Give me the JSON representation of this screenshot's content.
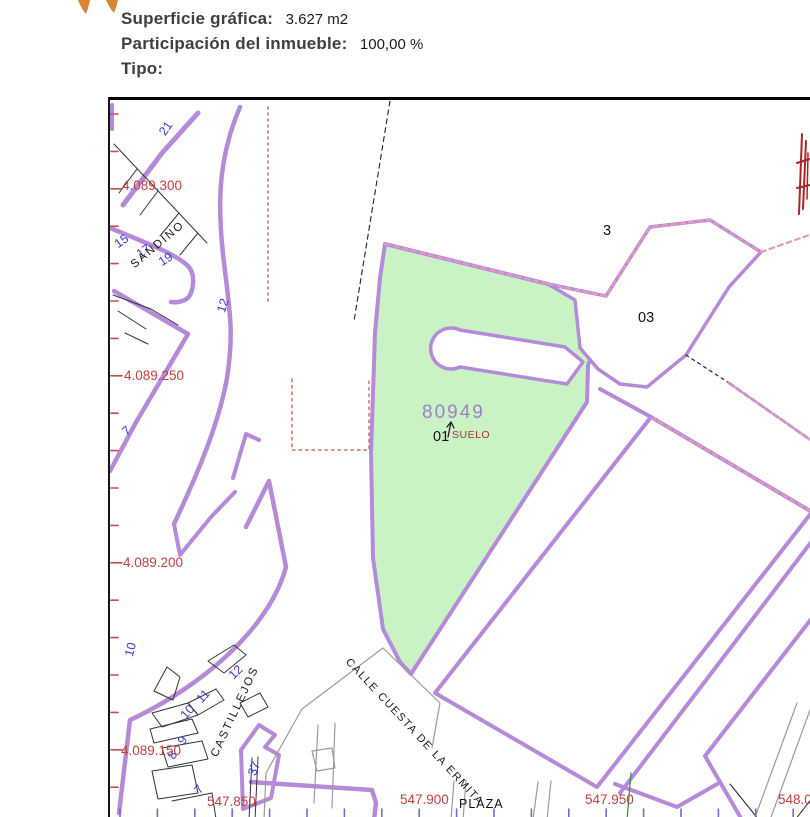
{
  "header": {
    "superficie_label": "Superficie gráfica:",
    "superficie_value": "3.627 m2",
    "participacion_label": "Participación del inmueble:",
    "participacion_value": "100,00 %",
    "tipo_label": "Tipo:",
    "tipo_value": ""
  },
  "map": {
    "parcel_id": "80949",
    "colors": {
      "boundary_purple": "#b58ad9",
      "parcel_fill_green": "#c9f3c5",
      "coordinate_red": "#c04040",
      "house_number_blue": "#3a3acc",
      "parcel_id_purple": "#9d7fd0",
      "dashed_pink": "#e49ac0"
    },
    "labels": [
      {
        "name": "house-number-21",
        "text": "21",
        "x": 160,
        "y": 125,
        "rot": -55,
        "cls": "blue"
      },
      {
        "name": "coord-y-4089300",
        "text": "4.089.300",
        "x": 120,
        "y": 176,
        "rot": 0,
        "cls": "red"
      },
      {
        "name": "house-number-15",
        "text": "15",
        "x": 114,
        "y": 236,
        "rot": -35,
        "cls": "blue"
      },
      {
        "name": "house-number-17",
        "text": "17",
        "x": 136,
        "y": 246,
        "rot": -35,
        "cls": "blue"
      },
      {
        "name": "house-number-19",
        "text": "19",
        "x": 158,
        "y": 254,
        "rot": -33,
        "cls": "blue"
      },
      {
        "name": "street-sandino",
        "text": "SANDINO",
        "x": 131,
        "y": 258,
        "rot": -40,
        "cls": "street"
      },
      {
        "name": "house-number-12-upper",
        "text": "12",
        "x": 219,
        "y": 303,
        "rot": -72,
        "cls": "blue"
      },
      {
        "name": "coord-y-4089250",
        "text": "4.089.250",
        "x": 122,
        "y": 366,
        "rot": 0,
        "cls": "red"
      },
      {
        "name": "house-number-7-left",
        "text": "7",
        "x": 122,
        "y": 424,
        "rot": -40,
        "cls": "blue"
      },
      {
        "name": "coord-y-4089200",
        "text": "4.089.200",
        "x": 121,
        "y": 553,
        "rot": 0,
        "cls": "red"
      },
      {
        "name": "house-number-10-left",
        "text": "10",
        "x": 127,
        "y": 647,
        "rot": -75,
        "cls": "blue"
      },
      {
        "name": "house-number-12-lower",
        "text": "12",
        "x": 229,
        "y": 668,
        "rot": -45,
        "cls": "blue"
      },
      {
        "name": "house-number-11",
        "text": "11",
        "x": 197,
        "y": 692,
        "rot": -48,
        "cls": "blue"
      },
      {
        "name": "house-number-10-lower",
        "text": "10",
        "x": 181,
        "y": 708,
        "rot": -48,
        "cls": "blue"
      },
      {
        "name": "house-number-9",
        "text": "9",
        "x": 179,
        "y": 734,
        "rot": -60,
        "cls": "blue"
      },
      {
        "name": "house-number-8",
        "text": "8",
        "x": 169,
        "y": 749,
        "rot": -60,
        "cls": "blue"
      },
      {
        "name": "street-castillejos",
        "text": "CASTILLEJOS",
        "x": 213,
        "y": 748,
        "rot": -65,
        "cls": "street"
      },
      {
        "name": "coord-y-4089150",
        "text": "4.089.150",
        "x": 119,
        "y": 741,
        "rot": 0,
        "cls": "red"
      },
      {
        "name": "house-number-37",
        "text": "37",
        "x": 250,
        "y": 766,
        "rot": -70,
        "cls": "blue"
      },
      {
        "name": "house-number-7-lower",
        "text": "7",
        "x": 195,
        "y": 783,
        "rot": -50,
        "cls": "blue"
      },
      {
        "name": "coord-x-547850",
        "text": "547.850",
        "x": 205,
        "y": 792,
        "rot": 0,
        "cls": "red"
      },
      {
        "name": "street-cuesta-ermita",
        "text": "CALLE CUESTA DE LA ERMITA",
        "x": 345,
        "y": 652,
        "rot": 47,
        "cls": "ermita"
      },
      {
        "name": "parcel-id-80949",
        "text": "80949",
        "x": 420,
        "y": 400,
        "rot": 0,
        "cls": "purple-id"
      },
      {
        "name": "parcel-sub-01",
        "text": "01",
        "x": 431,
        "y": 427,
        "rot": 0,
        "cls": "black15"
      },
      {
        "name": "parcel-suelo",
        "text": "SUELO",
        "x": 450,
        "y": 427,
        "rot": 0,
        "cls": "smallred"
      },
      {
        "name": "parcel-3",
        "text": "3",
        "x": 601,
        "y": 221,
        "rot": 0,
        "cls": "black15"
      },
      {
        "name": "parcel-03",
        "text": "03",
        "x": 636,
        "y": 308,
        "rot": 0,
        "cls": "black15"
      },
      {
        "name": "coord-x-547900",
        "text": "547.900",
        "x": 398,
        "y": 790,
        "rot": 0,
        "cls": "red"
      },
      {
        "name": "street-plaza",
        "text": "PLAZA",
        "x": 457,
        "y": 795,
        "rot": 0,
        "cls": "plaza"
      },
      {
        "name": "coord-x-547950",
        "text": "547.950",
        "x": 583,
        "y": 790,
        "rot": 0,
        "cls": "red"
      },
      {
        "name": "coord-x-54800",
        "text": "548.00",
        "x": 776,
        "y": 790,
        "rot": 0,
        "cls": "red"
      }
    ]
  }
}
